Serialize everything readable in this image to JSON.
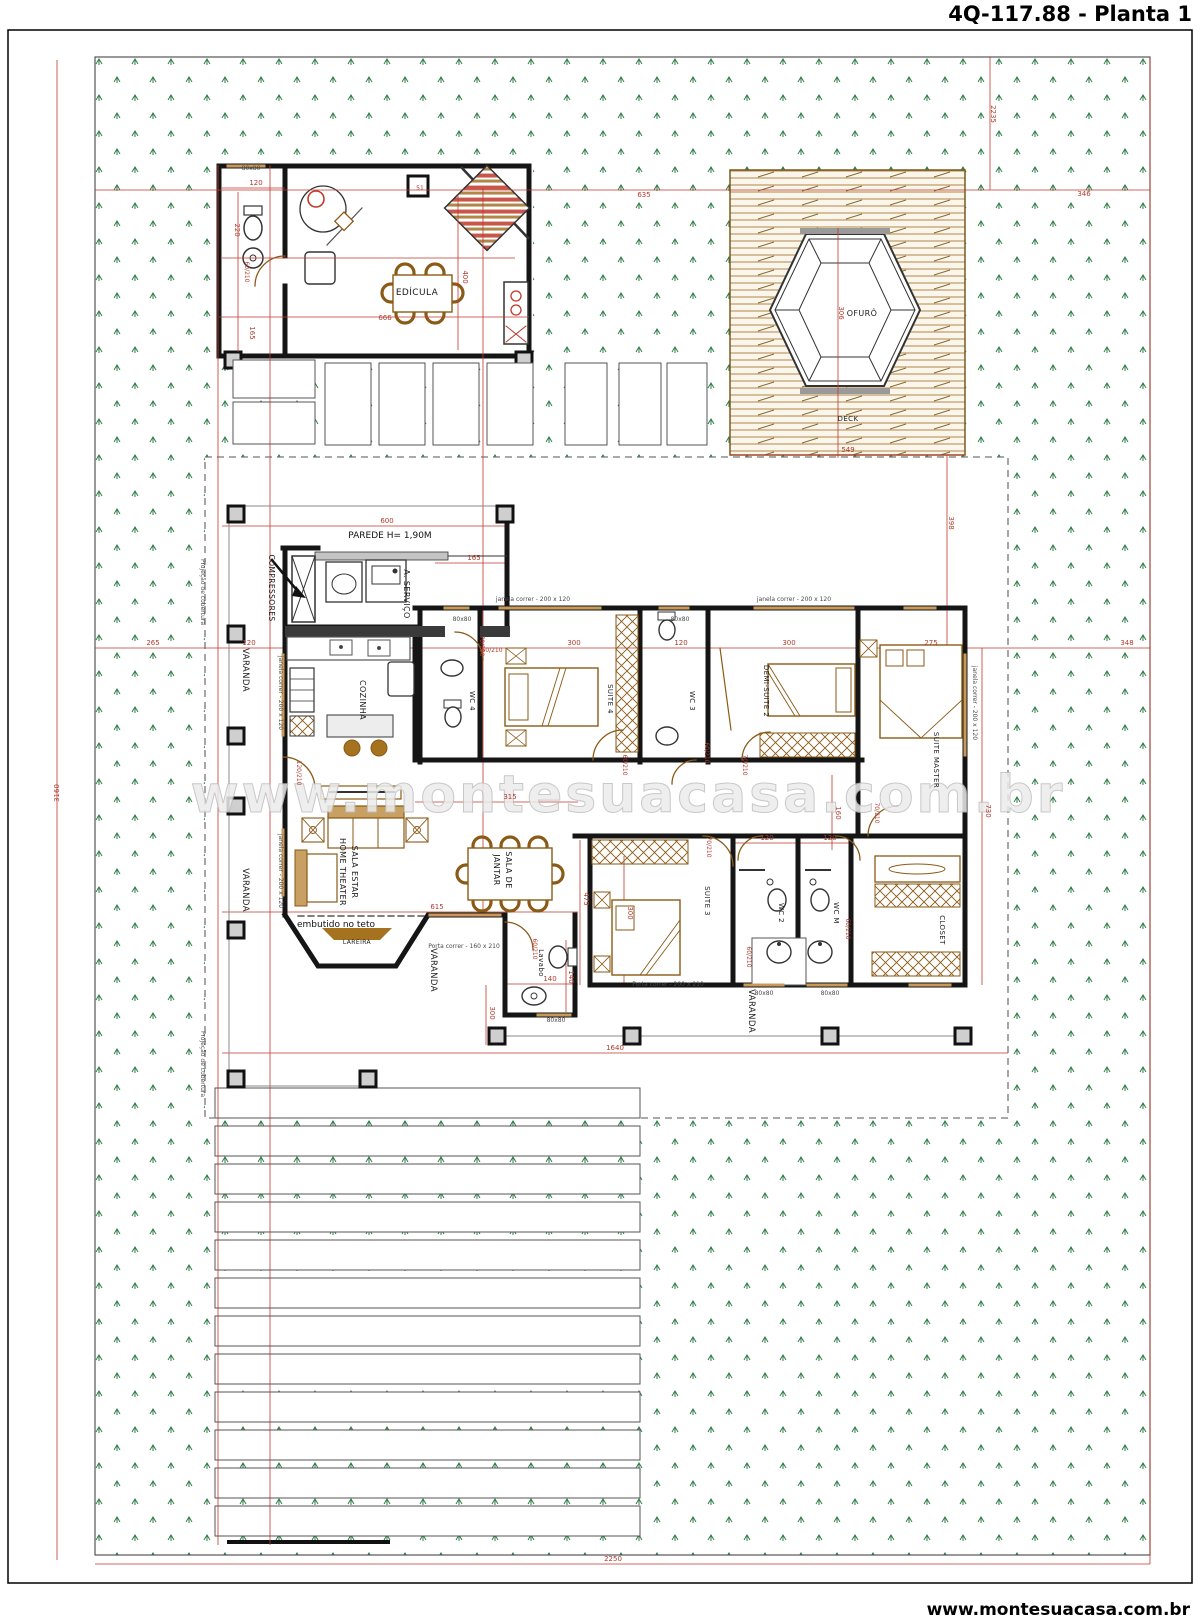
{
  "title": "4Q-117.88 - Planta 1",
  "footer": "www.montesuacasa.com.br",
  "watermark": "www.montesuacasa.com.br",
  "colors": {
    "dimension_red": "#b03a2e",
    "wall_black": "#151515",
    "furniture_wood": "#8a5a16",
    "grass_green": "#2f7d46",
    "deck_wood": "#b08748",
    "watermark_gray": "#d6d6d6"
  },
  "plan": {
    "labels": [
      {
        "t": "EDÍCULA",
        "x": 417,
        "y": 295,
        "s": 9,
        "c": "room",
        "n": "label-edicula"
      },
      {
        "t": "COMPRESSORES",
        "x": 269,
        "y": 588,
        "r": 90,
        "s": 7.5,
        "c": "room",
        "n": "label-compressores"
      },
      {
        "t": "A. SERVIÇO",
        "x": 404,
        "y": 594,
        "r": 90,
        "s": 8,
        "c": "room",
        "n": "label-area-servico"
      },
      {
        "t": "COZINHA",
        "x": 360,
        "y": 700,
        "r": 90,
        "s": 8,
        "c": "room",
        "n": "label-cozinha"
      },
      {
        "t": "SALA ESTAR",
        "x": 352,
        "y": 872,
        "r": 90,
        "s": 8,
        "c": "room",
        "n": "label-sala-estar"
      },
      {
        "t": "HOME THEATER",
        "x": 340,
        "y": 872,
        "r": 90,
        "s": 8,
        "c": "room",
        "n": "label-home-theater"
      },
      {
        "t": "SALA DE",
        "x": 506,
        "y": 870,
        "r": 90,
        "s": 8,
        "c": "room",
        "n": "label-sala-de-jantar"
      },
      {
        "t": "JANTAR",
        "x": 494,
        "y": 870,
        "r": 90,
        "s": 8,
        "c": "room",
        "n": "label-jantar"
      },
      {
        "t": "Lavabo",
        "x": 539,
        "y": 963,
        "r": 90,
        "s": 7,
        "c": "room",
        "n": "label-lavabo"
      },
      {
        "t": "WC 4",
        "x": 470,
        "y": 701,
        "r": 90,
        "s": 7,
        "c": "room",
        "n": "label-wc4"
      },
      {
        "t": "SUITE 4",
        "x": 608,
        "y": 699,
        "r": 90,
        "s": 7,
        "c": "room",
        "n": "label-suite4"
      },
      {
        "t": "WC 3",
        "x": 690,
        "y": 701,
        "r": 90,
        "s": 7,
        "c": "room",
        "n": "label-wc3"
      },
      {
        "t": "DEMI-SUITE 2",
        "x": 764,
        "y": 691,
        "r": 90,
        "s": 7,
        "c": "room",
        "n": "label-demi-suite2"
      },
      {
        "t": "SUITE MASTER",
        "x": 934,
        "y": 760,
        "r": 90,
        "s": 7,
        "c": "room",
        "n": "label-suite-master"
      },
      {
        "t": "SUITE 3",
        "x": 705,
        "y": 901,
        "r": 90,
        "s": 7,
        "c": "room",
        "n": "label-suite3"
      },
      {
        "t": "WC 2",
        "x": 779,
        "y": 913,
        "r": 90,
        "s": 7,
        "c": "room",
        "n": "label-wc2"
      },
      {
        "t": "WC M",
        "x": 834,
        "y": 913,
        "r": 90,
        "s": 7,
        "c": "room",
        "n": "label-wcm"
      },
      {
        "t": "CLOSET",
        "x": 940,
        "y": 930,
        "r": 90,
        "s": 7,
        "c": "room",
        "n": "label-closet"
      },
      {
        "t": "VARANDA",
        "x": 243,
        "y": 670,
        "r": 90,
        "s": 8.5,
        "c": "room",
        "n": "label-varanda-1"
      },
      {
        "t": "VARANDA",
        "x": 243,
        "y": 890,
        "r": 90,
        "s": 8.5,
        "c": "room",
        "n": "label-varanda-2"
      },
      {
        "t": "VARANDA",
        "x": 431,
        "y": 970,
        "r": 90,
        "s": 8.5,
        "c": "room",
        "n": "label-varanda-3"
      },
      {
        "t": "VARANDA",
        "x": 749,
        "y": 1011,
        "r": 90,
        "s": 8.5,
        "c": "room",
        "n": "label-varanda-4"
      },
      {
        "t": "OFURÔ",
        "x": 862,
        "y": 316,
        "s": 8,
        "c": "room",
        "n": "label-ofuro"
      },
      {
        "t": "DECK",
        "x": 848,
        "y": 421,
        "s": 7,
        "c": "room",
        "n": "label-deck"
      },
      {
        "t": "LAREIRA",
        "x": 357,
        "y": 944,
        "s": 6,
        "c": "room",
        "n": "label-lareira"
      },
      {
        "t": "PAREDE H= 1,90M",
        "x": 390,
        "y": 538,
        "s": 9,
        "c": "note",
        "n": "label-parede-nota"
      },
      {
        "t": "embutido no teto",
        "x": 336,
        "y": 927,
        "s": 9,
        "c": "note",
        "n": "label-embutido"
      },
      {
        "t": "Projeção de cobertura",
        "x": 201,
        "y": 592,
        "r": 90,
        "s": 6,
        "c": "ann",
        "n": "label-projecao-1"
      },
      {
        "t": "Projeção de cobertura",
        "x": 201,
        "y": 1064,
        "r": 90,
        "s": 6,
        "c": "ann",
        "n": "label-projecao-2"
      },
      {
        "t": "635",
        "x": 644,
        "y": 197,
        "c": "dim"
      },
      {
        "t": "346",
        "x": 1084,
        "y": 196,
        "c": "dim"
      },
      {
        "t": "2235",
        "x": 991,
        "y": 114,
        "r": 90,
        "c": "dim"
      },
      {
        "t": "3160",
        "x": 59,
        "y": 793,
        "r": -90,
        "c": "dim"
      },
      {
        "t": "2250",
        "x": 613,
        "y": 1561,
        "c": "dim"
      },
      {
        "t": "265",
        "x": 153,
        "y": 645,
        "c": "dim"
      },
      {
        "t": "120",
        "x": 249,
        "y": 645,
        "c": "dim"
      },
      {
        "t": "348",
        "x": 1127,
        "y": 645,
        "c": "dim"
      },
      {
        "t": "600",
        "x": 387,
        "y": 523,
        "c": "dim"
      },
      {
        "t": "165",
        "x": 474,
        "y": 560,
        "c": "dim"
      },
      {
        "t": "300",
        "x": 574,
        "y": 645,
        "c": "dim"
      },
      {
        "t": "120",
        "x": 681,
        "y": 645,
        "c": "dim"
      },
      {
        "t": "300",
        "x": 789,
        "y": 645,
        "c": "dim"
      },
      {
        "t": "275",
        "x": 931,
        "y": 645,
        "c": "dim"
      },
      {
        "t": "315",
        "x": 510,
        "y": 799,
        "c": "dim"
      },
      {
        "t": "615",
        "x": 437,
        "y": 909,
        "c": "dim"
      },
      {
        "t": "475",
        "x": 584,
        "y": 899,
        "r": 90,
        "c": "dim"
      },
      {
        "t": "300",
        "x": 628,
        "y": 913,
        "r": 90,
        "c": "dim"
      },
      {
        "t": "120",
        "x": 767,
        "y": 840,
        "c": "dim"
      },
      {
        "t": "120",
        "x": 830,
        "y": 840,
        "c": "dim"
      },
      {
        "t": "730",
        "x": 986,
        "y": 811,
        "r": 90,
        "c": "dim"
      },
      {
        "t": "160",
        "x": 836,
        "y": 813,
        "r": 90,
        "c": "dim"
      },
      {
        "t": "140",
        "x": 550,
        "y": 981,
        "c": "dim"
      },
      {
        "t": "140",
        "x": 569,
        "y": 977,
        "r": 90,
        "c": "dim"
      },
      {
        "t": "300",
        "x": 490,
        "y": 1013,
        "r": 90,
        "c": "dim"
      },
      {
        "t": "1640",
        "x": 615,
        "y": 1050,
        "c": "dim"
      },
      {
        "t": "549",
        "x": 848,
        "y": 452,
        "c": "dim"
      },
      {
        "t": "306",
        "x": 839,
        "y": 313,
        "r": 90,
        "c": "dim"
      },
      {
        "t": "398",
        "x": 949,
        "y": 523,
        "r": 90,
        "c": "dim"
      },
      {
        "t": "666",
        "x": 385,
        "y": 320,
        "c": "dim"
      },
      {
        "t": "400",
        "x": 463,
        "y": 277,
        "r": 90,
        "c": "dim"
      },
      {
        "t": "165",
        "x": 250,
        "y": 333,
        "r": 90,
        "c": "dim"
      },
      {
        "t": "120",
        "x": 256,
        "y": 185,
        "c": "dim"
      },
      {
        "t": "220",
        "x": 235,
        "y": 230,
        "r": 90,
        "c": "dim"
      },
      {
        "t": "51",
        "x": 420,
        "y": 190,
        "s": 6,
        "c": "dim"
      },
      {
        "t": "60/210",
        "x": 245,
        "y": 272,
        "r": 90,
        "s": 6,
        "c": "dim"
      },
      {
        "t": "70/210",
        "x": 480,
        "y": 646,
        "r": 90,
        "s": 6,
        "c": "dim"
      },
      {
        "t": "60/210",
        "x": 492,
        "y": 652,
        "s": 6,
        "c": "dim"
      },
      {
        "t": "120/210",
        "x": 297,
        "y": 773,
        "r": 90,
        "s": 6,
        "c": "dim"
      },
      {
        "t": "60/210",
        "x": 623,
        "y": 765,
        "r": 90,
        "s": 6,
        "c": "dim"
      },
      {
        "t": "60/210",
        "x": 705,
        "y": 753,
        "r": 90,
        "s": 6,
        "c": "dim"
      },
      {
        "t": "70/210",
        "x": 743,
        "y": 765,
        "r": 90,
        "s": 6,
        "c": "dim"
      },
      {
        "t": "70/210",
        "x": 707,
        "y": 847,
        "r": 90,
        "s": 6,
        "c": "dim"
      },
      {
        "t": "60/210",
        "x": 533,
        "y": 949,
        "r": 90,
        "s": 6,
        "c": "dim"
      },
      {
        "t": "60/210",
        "x": 747,
        "y": 957,
        "r": 90,
        "s": 6,
        "c": "dim"
      },
      {
        "t": "60/210",
        "x": 846,
        "y": 929,
        "r": 90,
        "s": 6,
        "c": "dim"
      },
      {
        "t": "70/210",
        "x": 875,
        "y": 813,
        "r": 90,
        "s": 6,
        "c": "dim"
      },
      {
        "t": "janela correr - 200 x 120",
        "x": 533,
        "y": 601,
        "s": 6,
        "c": "ann"
      },
      {
        "t": "janela correr - 200 x 120",
        "x": 794,
        "y": 601,
        "s": 6,
        "c": "ann"
      },
      {
        "t": "janela correr - 200 x 120",
        "x": 279,
        "y": 693,
        "r": 90,
        "s": 6,
        "c": "ann"
      },
      {
        "t": "janela correr - 200 x 120",
        "x": 279,
        "y": 871,
        "r": 90,
        "s": 6,
        "c": "ann"
      },
      {
        "t": "janela correr - 200 x 120",
        "x": 973,
        "y": 703,
        "r": 90,
        "s": 6,
        "c": "ann"
      },
      {
        "t": "80x80",
        "x": 251,
        "y": 170,
        "s": 6,
        "c": "ann"
      },
      {
        "t": "80x80",
        "x": 462,
        "y": 621,
        "s": 6,
        "c": "ann"
      },
      {
        "t": "80x80",
        "x": 680,
        "y": 621,
        "s": 6,
        "c": "ann"
      },
      {
        "t": "80x80",
        "x": 764,
        "y": 995,
        "s": 6,
        "c": "ann"
      },
      {
        "t": "80x80",
        "x": 830,
        "y": 995,
        "s": 6,
        "c": "ann"
      },
      {
        "t": "80x80",
        "x": 556,
        "y": 1022,
        "s": 6,
        "c": "ann"
      },
      {
        "t": "Porta correr - 160 x 210",
        "x": 464,
        "y": 948,
        "s": 6,
        "c": "ann"
      },
      {
        "t": "Porta correr - 200 x 210",
        "x": 668,
        "y": 986,
        "s": 6,
        "c": "ann"
      }
    ]
  }
}
